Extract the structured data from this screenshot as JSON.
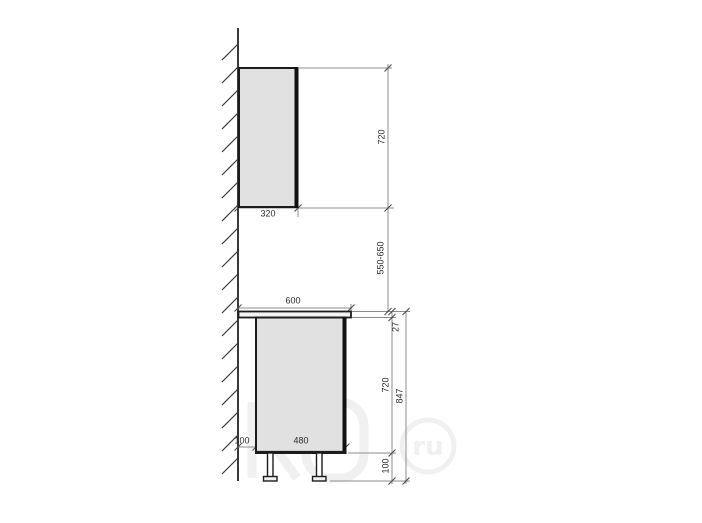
{
  "diagram": {
    "title": "kitchen-cabinet-side-elevation",
    "units": "mm",
    "colors": {
      "outline": "#1c1c1c",
      "cabinet_fill": "#e1e1e1",
      "countertop_fill": "#f4f4f4",
      "dimension_line": "#8c8c8c",
      "wall_line": "#3a3a3a",
      "text": "#2b2b2b"
    },
    "labels": {
      "wall_cabinet_depth": "320",
      "wall_cabinet_height": "720",
      "wall_to_counter_gap": "550-650",
      "countertop_depth": "600",
      "countertop_thickness": "27",
      "base_cabinet_height": "720",
      "base_total_height": "847",
      "base_back_gap": "100",
      "base_cabinet_depth": "480",
      "leg_height": "100"
    },
    "watermark": {
      "circle_text": "ru"
    }
  }
}
